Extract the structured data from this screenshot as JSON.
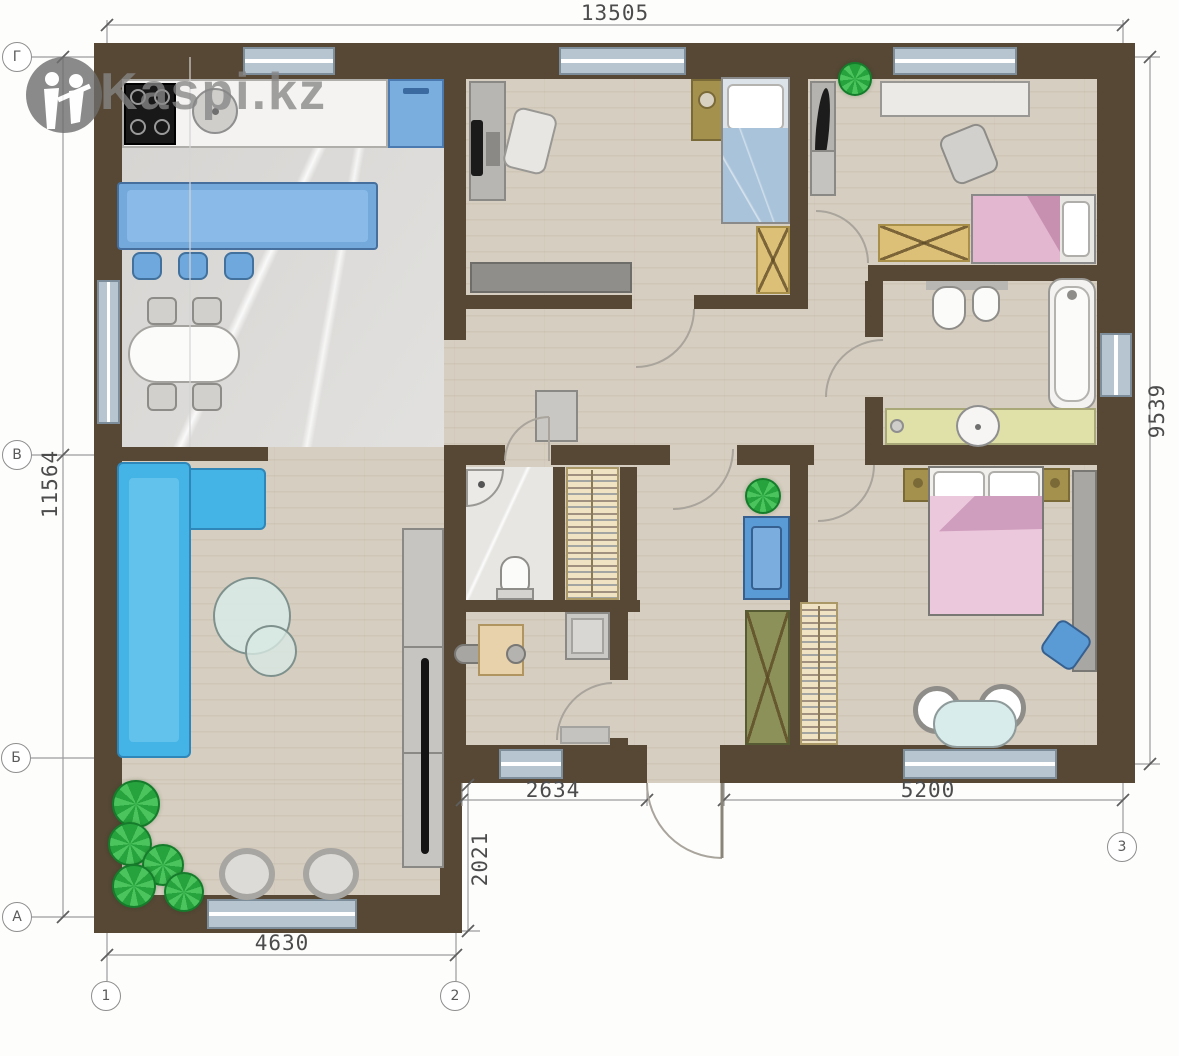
{
  "watermark": {
    "brand": "Kaspi.kz"
  },
  "dims": {
    "top": "13505",
    "left": "11564",
    "right": "9539",
    "bottom_left": "4630",
    "bottom_mid": "2634",
    "offset": "2021",
    "bottom_right": "5200"
  },
  "axes": {
    "rows": [
      "Г",
      "В",
      "Б",
      "А"
    ],
    "cols": [
      "1",
      "2",
      "3"
    ]
  },
  "colors": {
    "wall": "#564835",
    "accent_blue": "#45b3e6",
    "accent_pink": "#e9c6da",
    "plant_green": "#2fae44",
    "wood_floor": "#d6cec0"
  }
}
